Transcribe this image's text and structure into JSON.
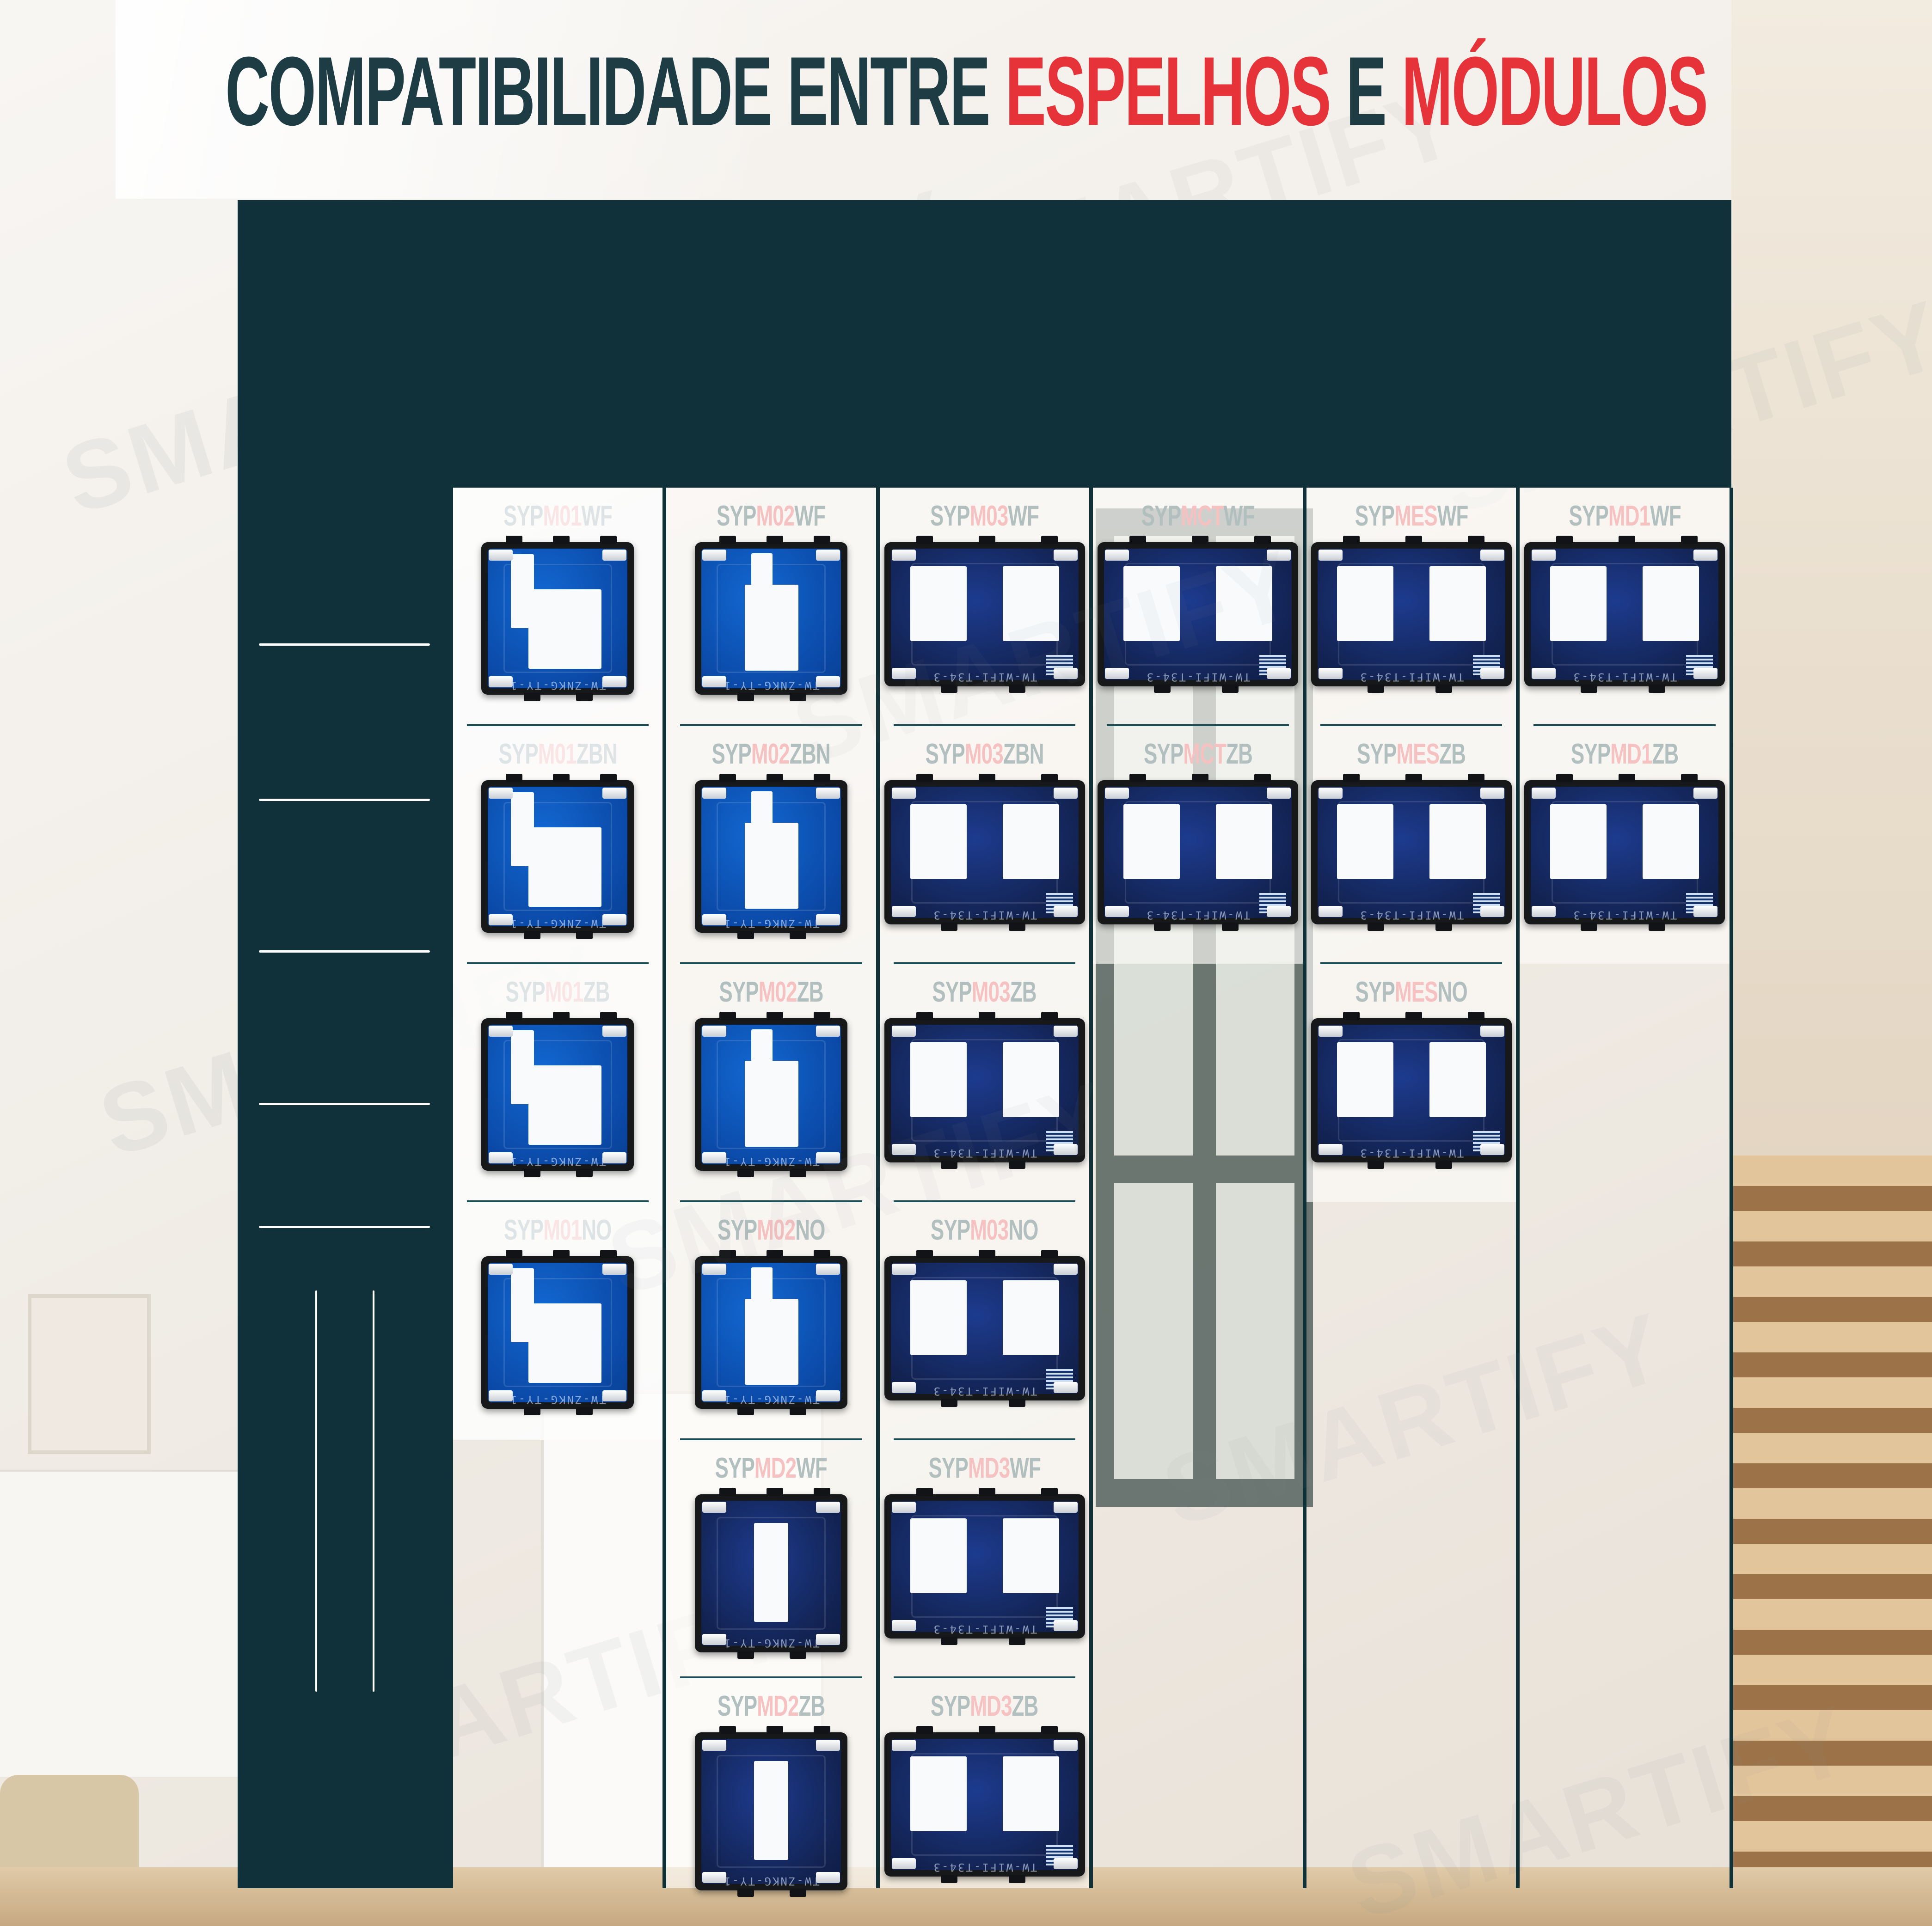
{
  "title": {
    "part1": "COMPATIBILIDADE ENTRE ",
    "part2": "ESPELHOS",
    "part3": " E ",
    "part4": "MÓDULOS"
  },
  "watermark": "SMARTIFY",
  "colors": {
    "dark_teal": "#11313a",
    "title_dark": "#1d3c44",
    "red": "#e6333a",
    "label_red": "#e8484e",
    "icon_teal": "#2ab9cc",
    "pcb_blue": "#0b4aa8",
    "pcb_navy": "#132455"
  },
  "header": {
    "products": [
      {
        "pre": "SYP",
        "hi": "E100",
        "suf": "BR",
        "panel": "frame",
        "icons": []
      },
      {
        "pre": "SYP",
        "hi": "E101",
        "suf": "BR",
        "panel": "touch",
        "icons": [
          "circle"
        ]
      },
      {
        "pre": "SYP",
        "hi": "E102",
        "suf": "BR",
        "panel": "touch",
        "icons": [
          "circle",
          "circle"
        ]
      },
      {
        "pre": "SYP",
        "hi": "E103",
        "suf": "BR",
        "panel": "touch",
        "icons": [
          "circle",
          "circle",
          "circle"
        ]
      },
      {
        "pre": "SYP",
        "hi": "E1CT",
        "suf": "BR",
        "panel": "touch",
        "icons": [
          "curtain-open",
          "pause",
          "curtain-close"
        ]
      },
      {
        "pre": "SYP",
        "hi": "E1ES",
        "suf": "BR",
        "panel": "touch",
        "icons": [
          "blind-open",
          "pause",
          "blind-close"
        ]
      },
      {
        "pre": "SYP",
        "hi": "E1D1",
        "suf": "BR",
        "panel": "touch",
        "icons": [
          "minus",
          "circle-sm",
          "plus"
        ]
      }
    ]
  },
  "sidebar": {
    "rows": [
      [
        {
          "hi": "MTE",
          "suf": "WF",
          "img": "socket"
        },
        {
          "hi": "MTUE",
          "suf": "WF",
          "img": "socket-usb-diag"
        }
      ],
      [
        {
          "hi": "MTE",
          "suf": "ZB",
          "img": "socket"
        },
        {
          "hi": "MTUE",
          "suf": "ZB",
          "img": "socket-usb-diag"
        }
      ],
      [
        {
          "hi": "MTE",
          "suf": "NO",
          "img": "socket"
        },
        {
          "hi": "MTUE",
          "suf": "NO",
          "img": "socket-usb-bottom"
        }
      ],
      [
        {
          "hi": "MTTA",
          "suf": "WF",
          "img": "thermostat"
        },
        {
          "hi": "MTTE",
          "suf": "WF",
          "img": "thermostat"
        }
      ],
      [
        {
          "hi": "MTTA",
          "suf": "ZB",
          "img": "thermostat"
        },
        {
          "hi": "MTTE",
          "suf": "ZB",
          "img": "thermostat"
        }
      ]
    ],
    "meios": {
      "hi": "MEIOS",
      "suf": " MÓDULOS"
    },
    "grid": [
      [
        "dual-usb-module",
        "tv-sat-module",
        "rj45-module"
      ],
      [
        "usbc-usba-module",
        "rca-av-module",
        "slot-module"
      ],
      [
        "two-pin-socket-module",
        "audio-jacks-module",
        "vga-module"
      ],
      [
        "hdmi-module",
        "usb-module",
        "banana-plug-module"
      ],
      [
        "coax-tv-module",
        "indicator-module",
        "blank-module"
      ]
    ],
    "footer": {
      "pre": "SYP",
      "hi": "OM",
      "suf": ""
    }
  },
  "columns": [
    {
      "cells": [
        {
          "pre": "SYP",
          "hi": "M01",
          "suf": "WF",
          "mod": "m1"
        },
        {
          "pre": "SYP",
          "hi": "M01",
          "suf": "ZBN",
          "mod": "m1"
        },
        {
          "pre": "SYP",
          "hi": "M01",
          "suf": "ZB",
          "mod": "m1"
        },
        {
          "pre": "SYP",
          "hi": "M01",
          "suf": "NO",
          "mod": "m1"
        }
      ]
    },
    {
      "cells": [
        {
          "pre": "SYP",
          "hi": "M02",
          "suf": "WF",
          "mod": "m2"
        },
        {
          "pre": "SYP",
          "hi": "M02",
          "suf": "ZBN",
          "mod": "m2"
        },
        {
          "pre": "SYP",
          "hi": "M02",
          "suf": "ZB",
          "mod": "m2"
        },
        {
          "pre": "SYP",
          "hi": "M02",
          "suf": "NO",
          "mod": "m2"
        },
        {
          "pre": "SYP",
          "hi": "MD2",
          "suf": "WF",
          "mod": "md2"
        },
        {
          "pre": "SYP",
          "hi": "MD2",
          "suf": "ZB",
          "mod": "md2"
        }
      ]
    },
    {
      "cells": [
        {
          "pre": "SYP",
          "hi": "M03",
          "suf": "WF",
          "mod": "wide"
        },
        {
          "pre": "SYP",
          "hi": "M03",
          "suf": "ZBN",
          "mod": "wide"
        },
        {
          "pre": "SYP",
          "hi": "M03",
          "suf": "ZB",
          "mod": "wide"
        },
        {
          "pre": "SYP",
          "hi": "M03",
          "suf": "NO",
          "mod": "wide"
        },
        {
          "pre": "SYP",
          "hi": "MD3",
          "suf": "WF",
          "mod": "wide"
        },
        {
          "pre": "SYP",
          "hi": "MD3",
          "suf": "ZB",
          "mod": "wide"
        }
      ]
    },
    {
      "cells": [
        {
          "pre": "SYP",
          "hi": "MCT",
          "suf": "WF",
          "mod": "wide"
        },
        {
          "pre": "SYP",
          "hi": "MCT",
          "suf": "ZB",
          "mod": "wide"
        }
      ]
    },
    {
      "cells": [
        {
          "pre": "SYP",
          "hi": "MES",
          "suf": "WF",
          "mod": "wide"
        },
        {
          "pre": "SYP",
          "hi": "MES",
          "suf": "ZB",
          "mod": "wide"
        },
        {
          "pre": "SYP",
          "hi": "MES",
          "suf": "NO",
          "mod": "wide"
        }
      ]
    },
    {
      "cells": [
        {
          "pre": "SYP",
          "hi": "MD1",
          "suf": "WF",
          "mod": "wide"
        },
        {
          "pre": "SYP",
          "hi": "MD1",
          "suf": "ZB",
          "mod": "wide"
        }
      ]
    }
  ],
  "modules": {
    "pcb_text_small": "TW-ZNKG-TY-1",
    "pcb_text_wide": "TW-WIFI-T34-3"
  }
}
